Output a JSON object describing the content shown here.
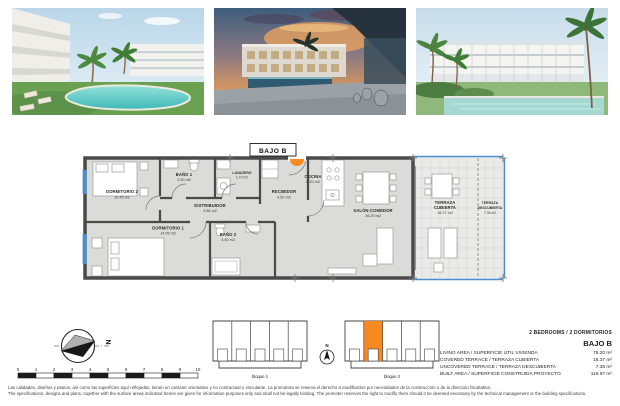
{
  "plan": {
    "unit_tag": "BAJO B",
    "rooms": [
      {
        "name": "DORMITORIO 2",
        "area": "10.45 m2"
      },
      {
        "name": "DORMITORIO 1",
        "area": "14.05 m2"
      },
      {
        "name": "BAÑO 1",
        "area": "3.90 m2"
      },
      {
        "name": "DISTRIBUIDOR",
        "area": "3.56 m2"
      },
      {
        "name": "LAVADERO",
        "area": "1.70 m2"
      },
      {
        "name": "RECIBIDOR",
        "area": "4.50 m2"
      },
      {
        "name": "BAÑO 2",
        "area": "4.40 m2"
      },
      {
        "name": "COCINA",
        "area": "8.20 m2"
      },
      {
        "name": "SALÓN-COMEDOR",
        "area": "26.20 m2"
      },
      {
        "name": "TERRAZA",
        "name2": "CUBIERTA",
        "area": "16.37 m2"
      },
      {
        "name": "TERRAZA",
        "name2": "DESCUBIERTA",
        "area": "7.35 m2"
      }
    ]
  },
  "compass": {
    "north_label": "N"
  },
  "scalebar": {
    "ticks": [
      "0",
      "1",
      "2",
      "3",
      "4",
      "5",
      "6",
      "7",
      "8",
      "9",
      "10"
    ]
  },
  "site": {
    "north_label": "N",
    "blocks": [
      {
        "label": "bloque 1"
      },
      {
        "label": "bloque 2"
      }
    ]
  },
  "specs": {
    "bedrooms_line": "2 BEDROOMS / 2 DORMITORIOS",
    "unit": "BAJO B",
    "rows": [
      {
        "label": "LIVING AREA / SUPERFICIE ÚTIL VIVIENDA",
        "value": "76.20 m²"
      },
      {
        "label": "COVERED TERRACE / TERRAZA CUBIERTA",
        "value": "16.37 m²"
      },
      {
        "label": "UNCOVERED TERRACE / TERRAZA DESCUBIERTA",
        "value": "7.35 m²"
      },
      {
        "label": "BUILT AREA / SUPERFICIE CONSTRUIDA PROYECTO",
        "value": "119.97 m²"
      }
    ]
  },
  "disclaimer": {
    "es": "Las calidades, diseños y planos, así como las superficies aquí reflejadas, tienen un carácter orientativo y no contractual o vinculante. La promotora se reserva el derecho a modificarlos por necesidades de la construcción o de la dirección facultativa.",
    "en": "The specifications, designs and plans, together with the surface areas indicated herein are given for information purposes only and shall not be legally binding. The promoter reserves the right to modify them should it be deemed necessary by the technical management or the building specifications."
  },
  "colors": {
    "accent_orange": "#F6891F",
    "glass_blue": "#4D8FCC",
    "wall_gray": "#4A4A4A",
    "floor_gray": "#DBDBD9"
  }
}
